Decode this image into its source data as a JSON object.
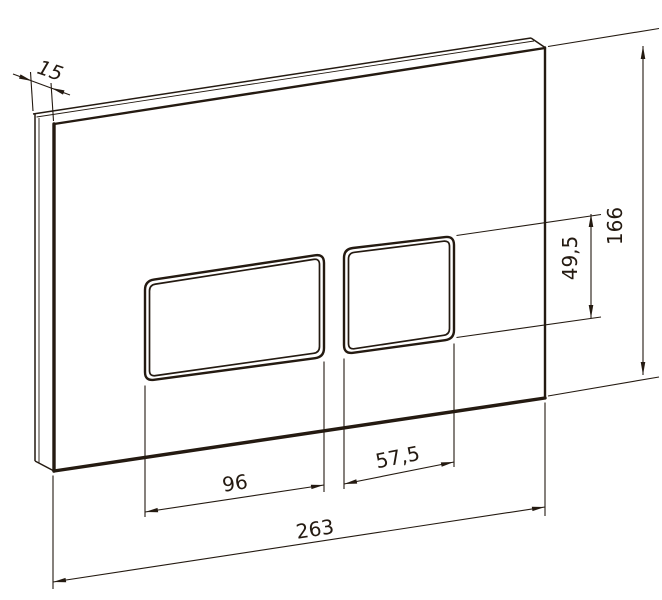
{
  "drawing": {
    "type": "technical-dimension-drawing",
    "subject": "wall-mounted toilet flush plate with two rectangular buttons, 3/4 perspective view",
    "units": "mm",
    "line_color": "#241a11",
    "background_color": "#ffffff",
    "dimensions": {
      "plate_thickness": "15",
      "plate_height": "166",
      "button_height": "49,5",
      "large_button_width": "96",
      "small_button_width": "57,5",
      "plate_width": "263"
    }
  }
}
